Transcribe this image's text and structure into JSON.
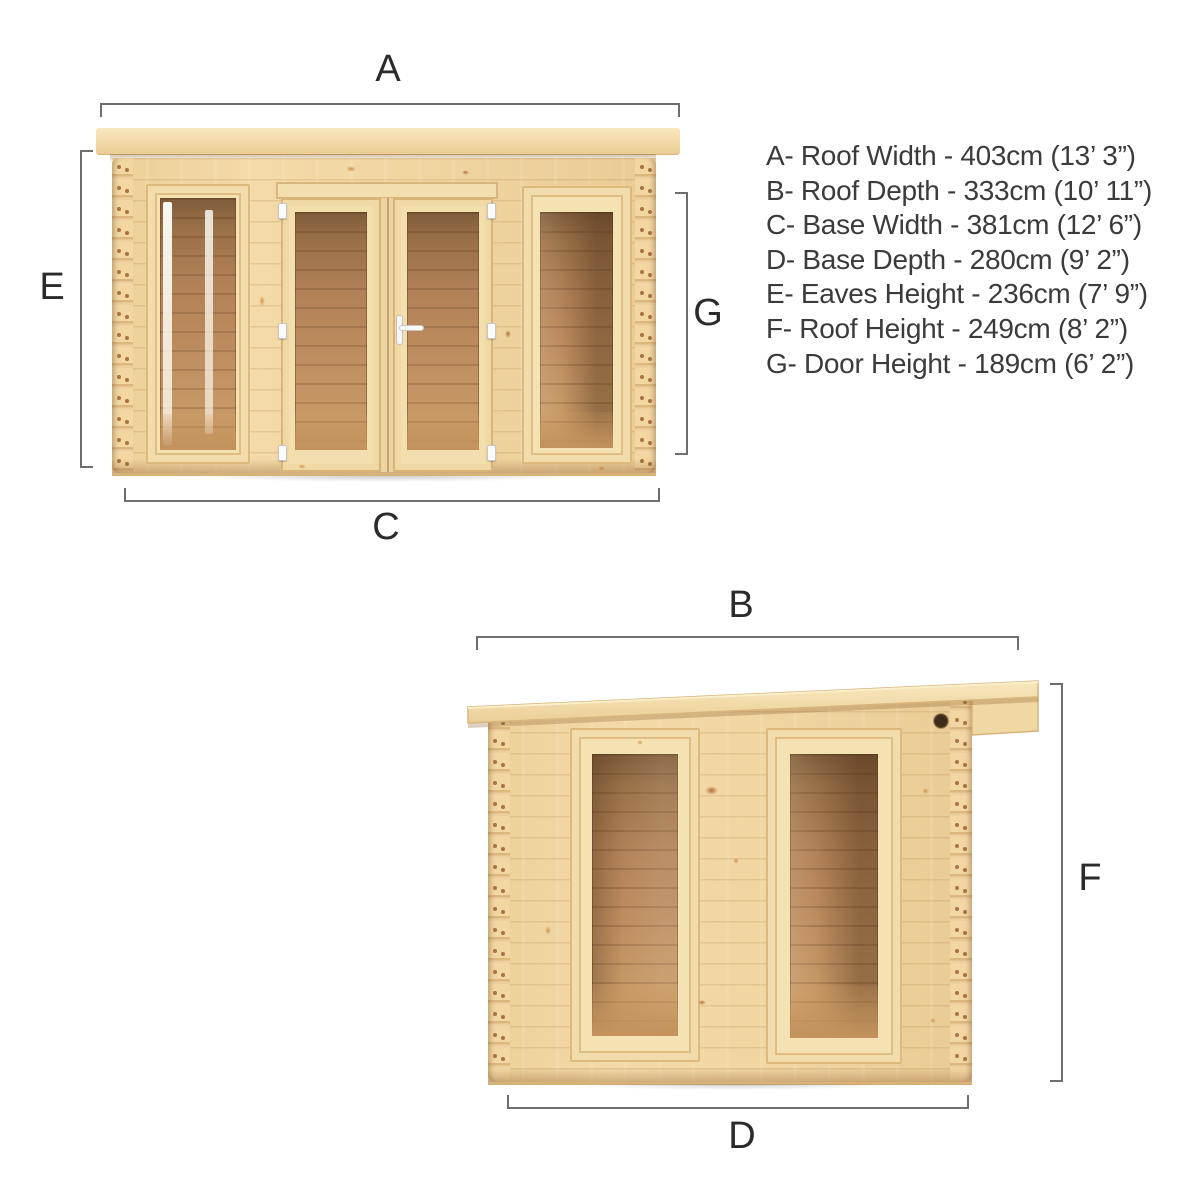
{
  "front_view": {
    "label_top": "A",
    "label_left": "E",
    "label_right": "G",
    "label_bottom": "C"
  },
  "side_view": {
    "label_top": "B",
    "label_right": "F",
    "label_bottom": "D"
  },
  "specs": {
    "lines": [
      "A- Roof Width - 403cm (13’ 3”)",
      "B- Roof Depth - 333cm (10’ 11”)",
      "C- Base Width - 381cm (12’ 6”)",
      "D- Base Depth - 280cm (9’ 2”)",
      "E- Eaves Height - 236cm (7’ 9”)",
      "F- Roof Height - 249cm (8’ 2”)",
      "G- Door Height - 189cm (6’ 2”)"
    ]
  },
  "colors": {
    "wood_wall": "#f0d4a0",
    "wood_frame": "#f5e2b2",
    "wood_roof": "#f3dcab",
    "interior_wood": "#b8895c",
    "dimension_line": "#6e6e6e",
    "label_text": "#2b2b2b",
    "spec_text": "#3b3b3b",
    "hardware_white": "#fbfbfb",
    "vent_hole": "#3c2c1b"
  }
}
